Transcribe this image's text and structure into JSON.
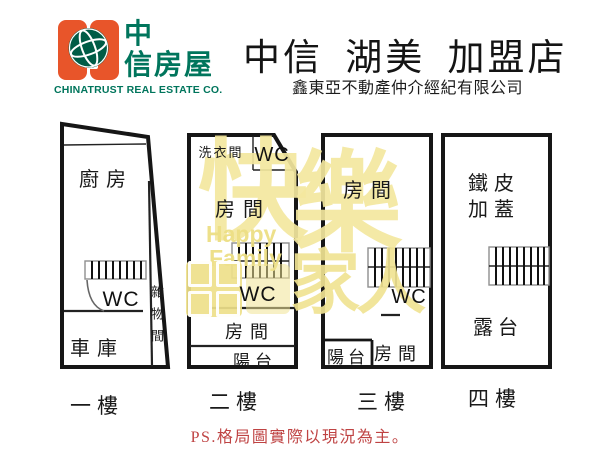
{
  "brand": {
    "logo_cn_top": "中",
    "logo_cn_bottom": "信房屋",
    "logo_en": "CHINATRUST REAL ESTATE CO.",
    "store_title": "中信 湖美 加盟店",
    "store_subtitle": "鑫東亞不動產仲介經紀有限公司"
  },
  "colors": {
    "brand_orange": "#e8552a",
    "brand_green": "#00755c",
    "globe_green": "#005c46",
    "footnote_red": "#bf4343",
    "watermark_yellow": "#f0e49c",
    "wall_black": "#161616"
  },
  "watermark": {
    "cn_top_1": "快",
    "cn_top_2": "樂",
    "en_line1": "Happy",
    "en_line2": "Family",
    "cn_bottom": "家人"
  },
  "floor1": {
    "label": "一樓",
    "kitchen": "廚房",
    "wc": "WC",
    "garage": "車庫",
    "storage_room": "雜物間"
  },
  "floor2": {
    "label": "二樓",
    "laundry": "洗衣間",
    "wc_top": "WC",
    "room_upper": "房間",
    "wc": "WC",
    "room_lower": "房間",
    "balcony": "陽台"
  },
  "floor3": {
    "label": "三樓",
    "room_upper": "房間",
    "wc": "WC",
    "balcony": "陽台",
    "room_lower": "房間"
  },
  "floor4": {
    "label": "四樓",
    "rooftop_line1": "鐵皮",
    "rooftop_line2": "加蓋",
    "terrace": "露台"
  },
  "footnote": "PS.格局圖實際以現況為主。"
}
